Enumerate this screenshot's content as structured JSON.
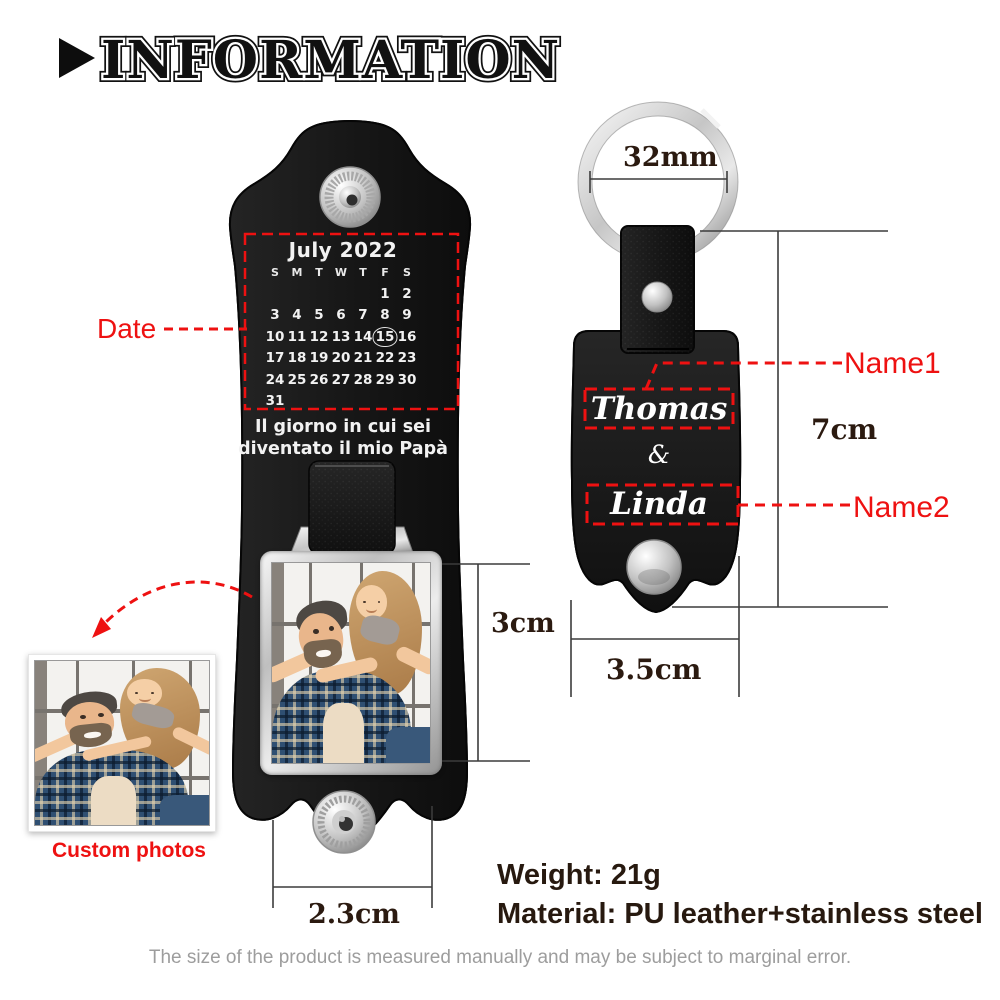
{
  "title": {
    "text": "INFORMATION",
    "icon": "right-triangle-icon"
  },
  "left_keychain": {
    "calendar": {
      "title": "July 2022",
      "day_headers": [
        "S",
        "M",
        "T",
        "W",
        "T",
        "F",
        "S"
      ],
      "weeks": [
        [
          "",
          "",
          "",
          "",
          "",
          "1",
          "2"
        ],
        [
          "3",
          "4",
          "5",
          "6",
          "7",
          "8",
          "9"
        ],
        [
          "10",
          "11",
          "12",
          "13",
          "14",
          "15",
          "16"
        ],
        [
          "17",
          "18",
          "19",
          "20",
          "21",
          "22",
          "23"
        ],
        [
          "24",
          "25",
          "26",
          "27",
          "28",
          "29",
          "30"
        ],
        [
          "31",
          "",
          "",
          "",
          "",
          "",
          ""
        ]
      ],
      "highlighted_day": "15"
    },
    "caption_line1": "Il giorno in cui sei",
    "caption_line2": "diventato il mio Papà",
    "date_label": "Date",
    "custom_photos_label": "Custom photos",
    "photo_alt": "dad carrying daughter piggyback in front of a window"
  },
  "right_keychain": {
    "name1": "Thomas",
    "ampersand": "&",
    "name2": "Linda",
    "name1_label": "Name1",
    "name2_label": "Name2"
  },
  "measurements": {
    "ring_diameter": "32mm",
    "fob_height": "7cm",
    "fob_width": "3.5cm",
    "photo_height": "3cm",
    "strap_width": "2.3cm"
  },
  "specs": {
    "weight_line": "Weight: 21g",
    "material_line": "Material: PU leather+stainless steel"
  },
  "footer": {
    "disclaimer": "The size of the product is measured manually and may be subject to marginal error."
  },
  "colors": {
    "accent_red": "#ee1111",
    "leather_black": "#171717",
    "silver": "#c9c9c9",
    "measure_text": "#2b1a10",
    "disclaimer_gray": "#9d9d9d"
  }
}
